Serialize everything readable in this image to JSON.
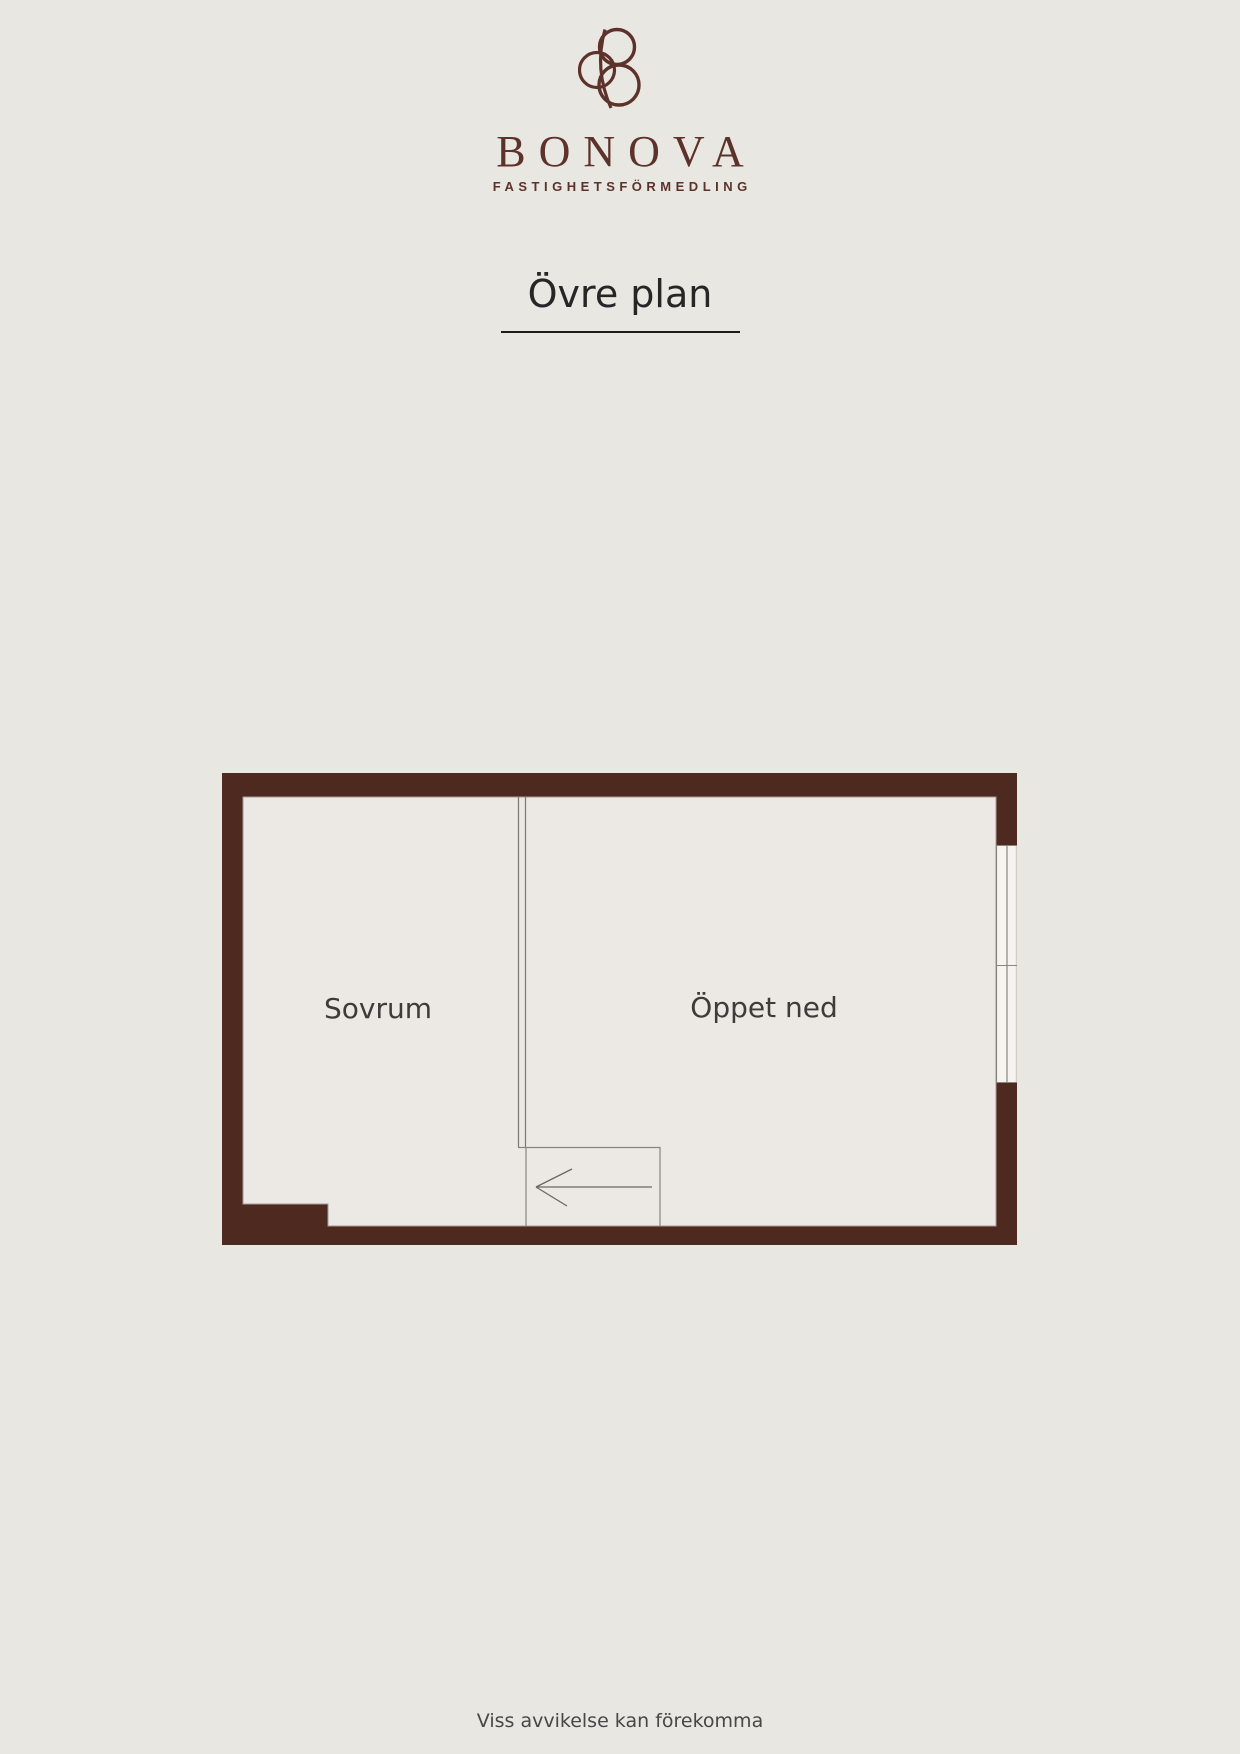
{
  "brand": {
    "name": "BONOVA",
    "tagline": "FASTIGHETSFÖRMEDLING"
  },
  "page": {
    "title": "Övre plan",
    "footer_disclaimer": "Viss avvikelse kan förekomma"
  },
  "floorplan": {
    "rooms": [
      {
        "label": "Sovrum"
      },
      {
        "label": "Öppet ned"
      }
    ],
    "stairs_arrow_direction": "left",
    "windows_on_right_wall": 2
  },
  "colors": {
    "background": "#e9e7e2",
    "wall": "#4e291f",
    "floor_fill": "#ece8e4",
    "window_fill": "#f6f4f1",
    "brand_maroon": "#5d322a",
    "title_text": "#262626",
    "room_label_text": "#3e3b38",
    "plan_line_gray": "#7c7671"
  }
}
